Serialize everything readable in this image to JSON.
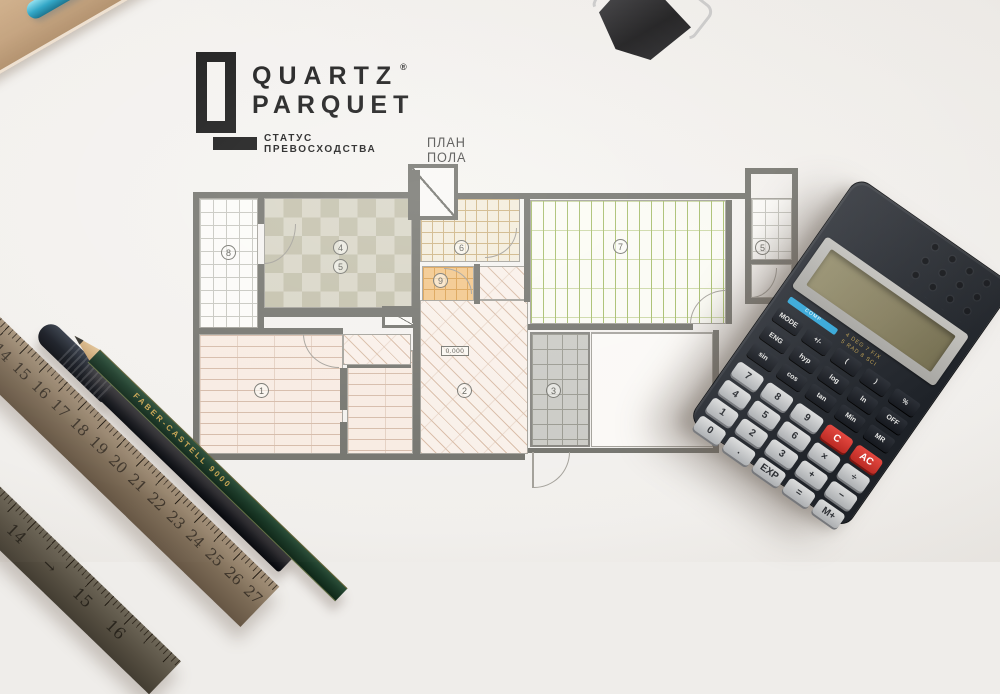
{
  "meta": {
    "description": "Flat-lay photo: Quartz Parquet branded floor plan with scientific calculator, metal rulers, black pen and green pencil",
    "background": "#efedea"
  },
  "branding": {
    "line1": "QUARTZ",
    "line2": "PARQUET",
    "reg": "®",
    "tagline": "СТАТУС ПРЕВОСХОДСТВА",
    "plan_title": "ПЛАН ПОЛА",
    "logo_color": "#141414"
  },
  "floor_plan": {
    "elevation": "0.000",
    "labels": {
      "r1": "1",
      "r2": "2",
      "r3": "3",
      "r4": "4",
      "r5": "5",
      "r6": "6",
      "r7": "7",
      "r8": "8",
      "r9": "9",
      "r10": "5"
    },
    "finishes": {
      "room1": "light wood planks",
      "room2": "diagonal parquet hatch",
      "room3": "grey tile",
      "room4_5": "checker tile",
      "room6": "beige tile",
      "room7": "green plank",
      "room8": "white tile balcony",
      "room9": "orange tile"
    }
  },
  "calculator": {
    "body_color": "#24282e",
    "display_color": "#8e8a6c",
    "accent_blue": "#35a7d8",
    "accent_red": "#d6352c",
    "stripe_label": "COMP",
    "hints_line1": "4 DEG  7 FIX",
    "hints_line2": "5 RAD  8 SCI",
    "small_keys": [
      "MODE",
      "+/-",
      "(",
      ")",
      "%",
      "ENG",
      "hyp",
      "log",
      "ln",
      "OFF",
      "sin",
      "cos",
      "tan",
      "Min",
      "MR"
    ],
    "main_keys": [
      {
        "t": "7"
      },
      {
        "t": "8"
      },
      {
        "t": "9"
      },
      {
        "t": "C",
        "c": "kred"
      },
      {
        "t": "AC",
        "c": "kred"
      },
      {
        "t": "4"
      },
      {
        "t": "5"
      },
      {
        "t": "6"
      },
      {
        "t": "×"
      },
      {
        "t": "÷"
      },
      {
        "t": "1"
      },
      {
        "t": "2"
      },
      {
        "t": "3"
      },
      {
        "t": "+"
      },
      {
        "t": "−"
      },
      {
        "t": "0"
      },
      {
        "t": "."
      },
      {
        "t": "EXP"
      },
      {
        "t": "="
      },
      {
        "t": "M+"
      }
    ]
  },
  "ruler_primary": {
    "numbers": [
      "13",
      "14",
      "15",
      "16",
      "17",
      "18",
      "19",
      "20",
      "21",
      "22",
      "23",
      "24",
      "25",
      "26",
      "27"
    ]
  },
  "ruler_secondary": {
    "numbers": [
      "13",
      "14",
      "→",
      "15",
      "16"
    ]
  },
  "pencil": {
    "brand": "FABER-CASTELL 9000"
  }
}
